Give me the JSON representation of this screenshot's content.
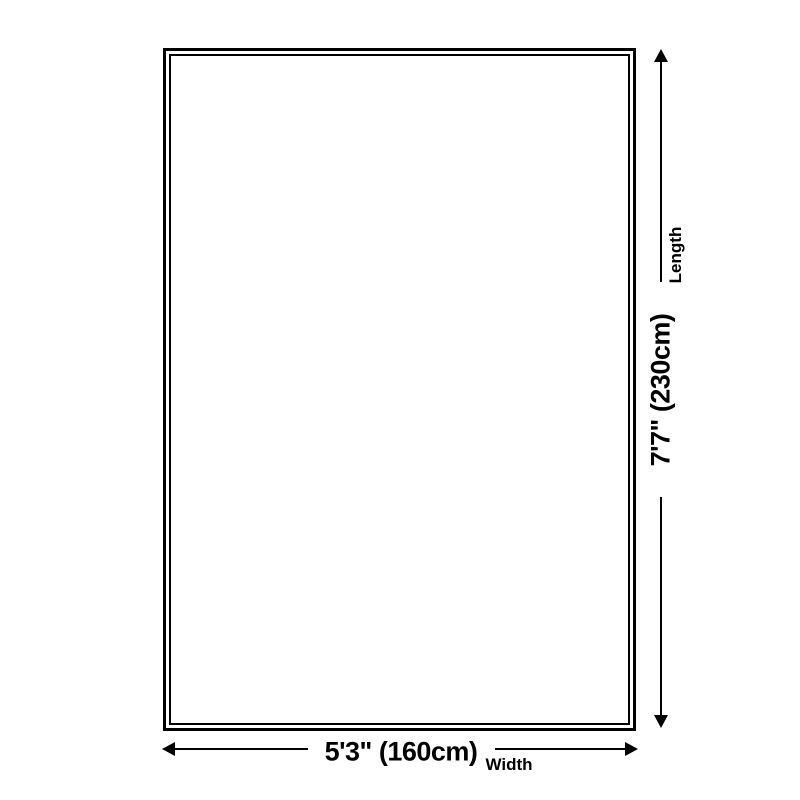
{
  "colors": {
    "background": "#ffffff",
    "line": "#000000",
    "text": "#000000"
  },
  "diagram": {
    "type": "rug-size-diagram",
    "length": {
      "value": "7'7\" (230cm)",
      "label": "Length"
    },
    "width": {
      "value": "5'3\" (160cm)",
      "label": "Width"
    }
  }
}
